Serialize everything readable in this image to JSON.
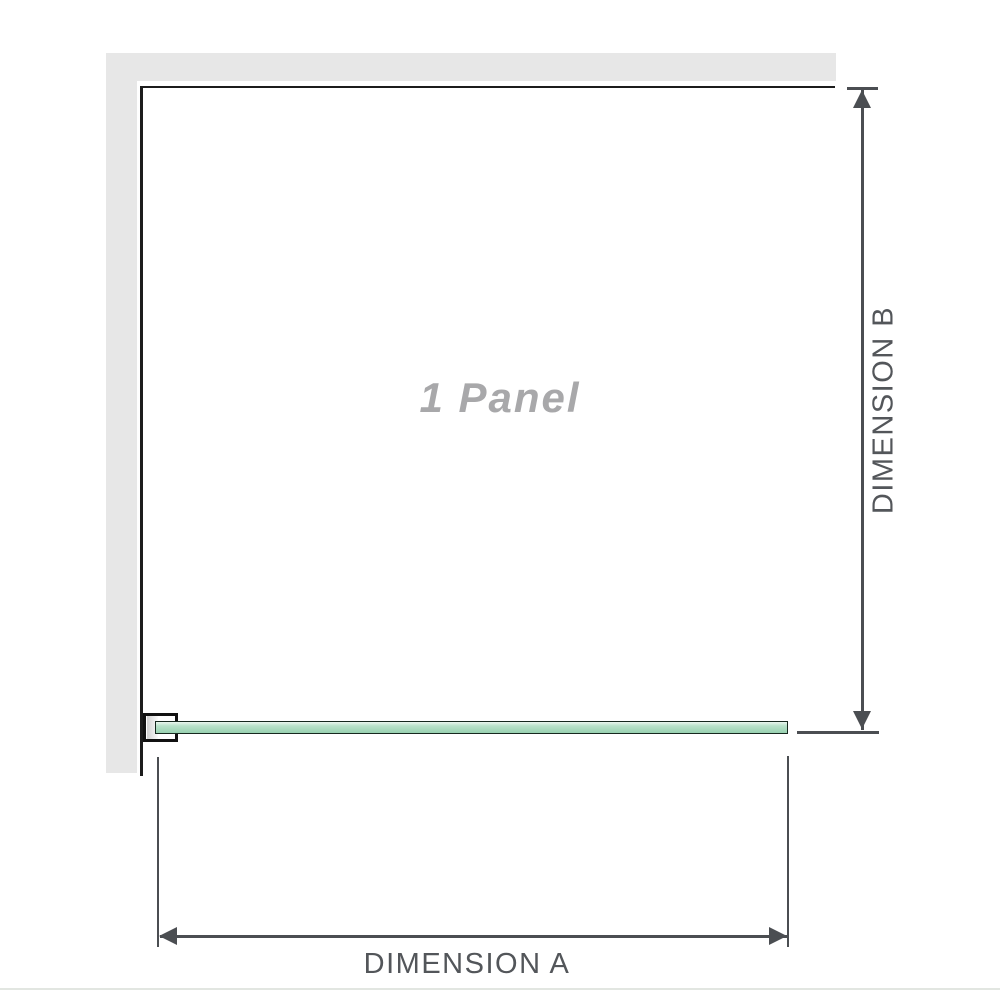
{
  "diagram": {
    "panel_label": "1 Panel",
    "dimension_a_label": "DIMENSION A",
    "dimension_b_label": "DIMENSION B"
  },
  "colors": {
    "page_bg": "#ffffff",
    "wall": "#e7e7e7",
    "panel_border": "#1c1c1c",
    "glass_border": "#16281e",
    "glass_top": "#eaf6ef",
    "glass_mid": "#b9e2ca",
    "glass_bottom": "#98d1b0",
    "dimension": "#4b4e52",
    "label_text": "#53565a",
    "panel_label_text": "#a8a8aa",
    "bracket_border": "#111111",
    "bracket_channel": "#d0d0d0",
    "bottom_rule": "#e2e6e1"
  }
}
